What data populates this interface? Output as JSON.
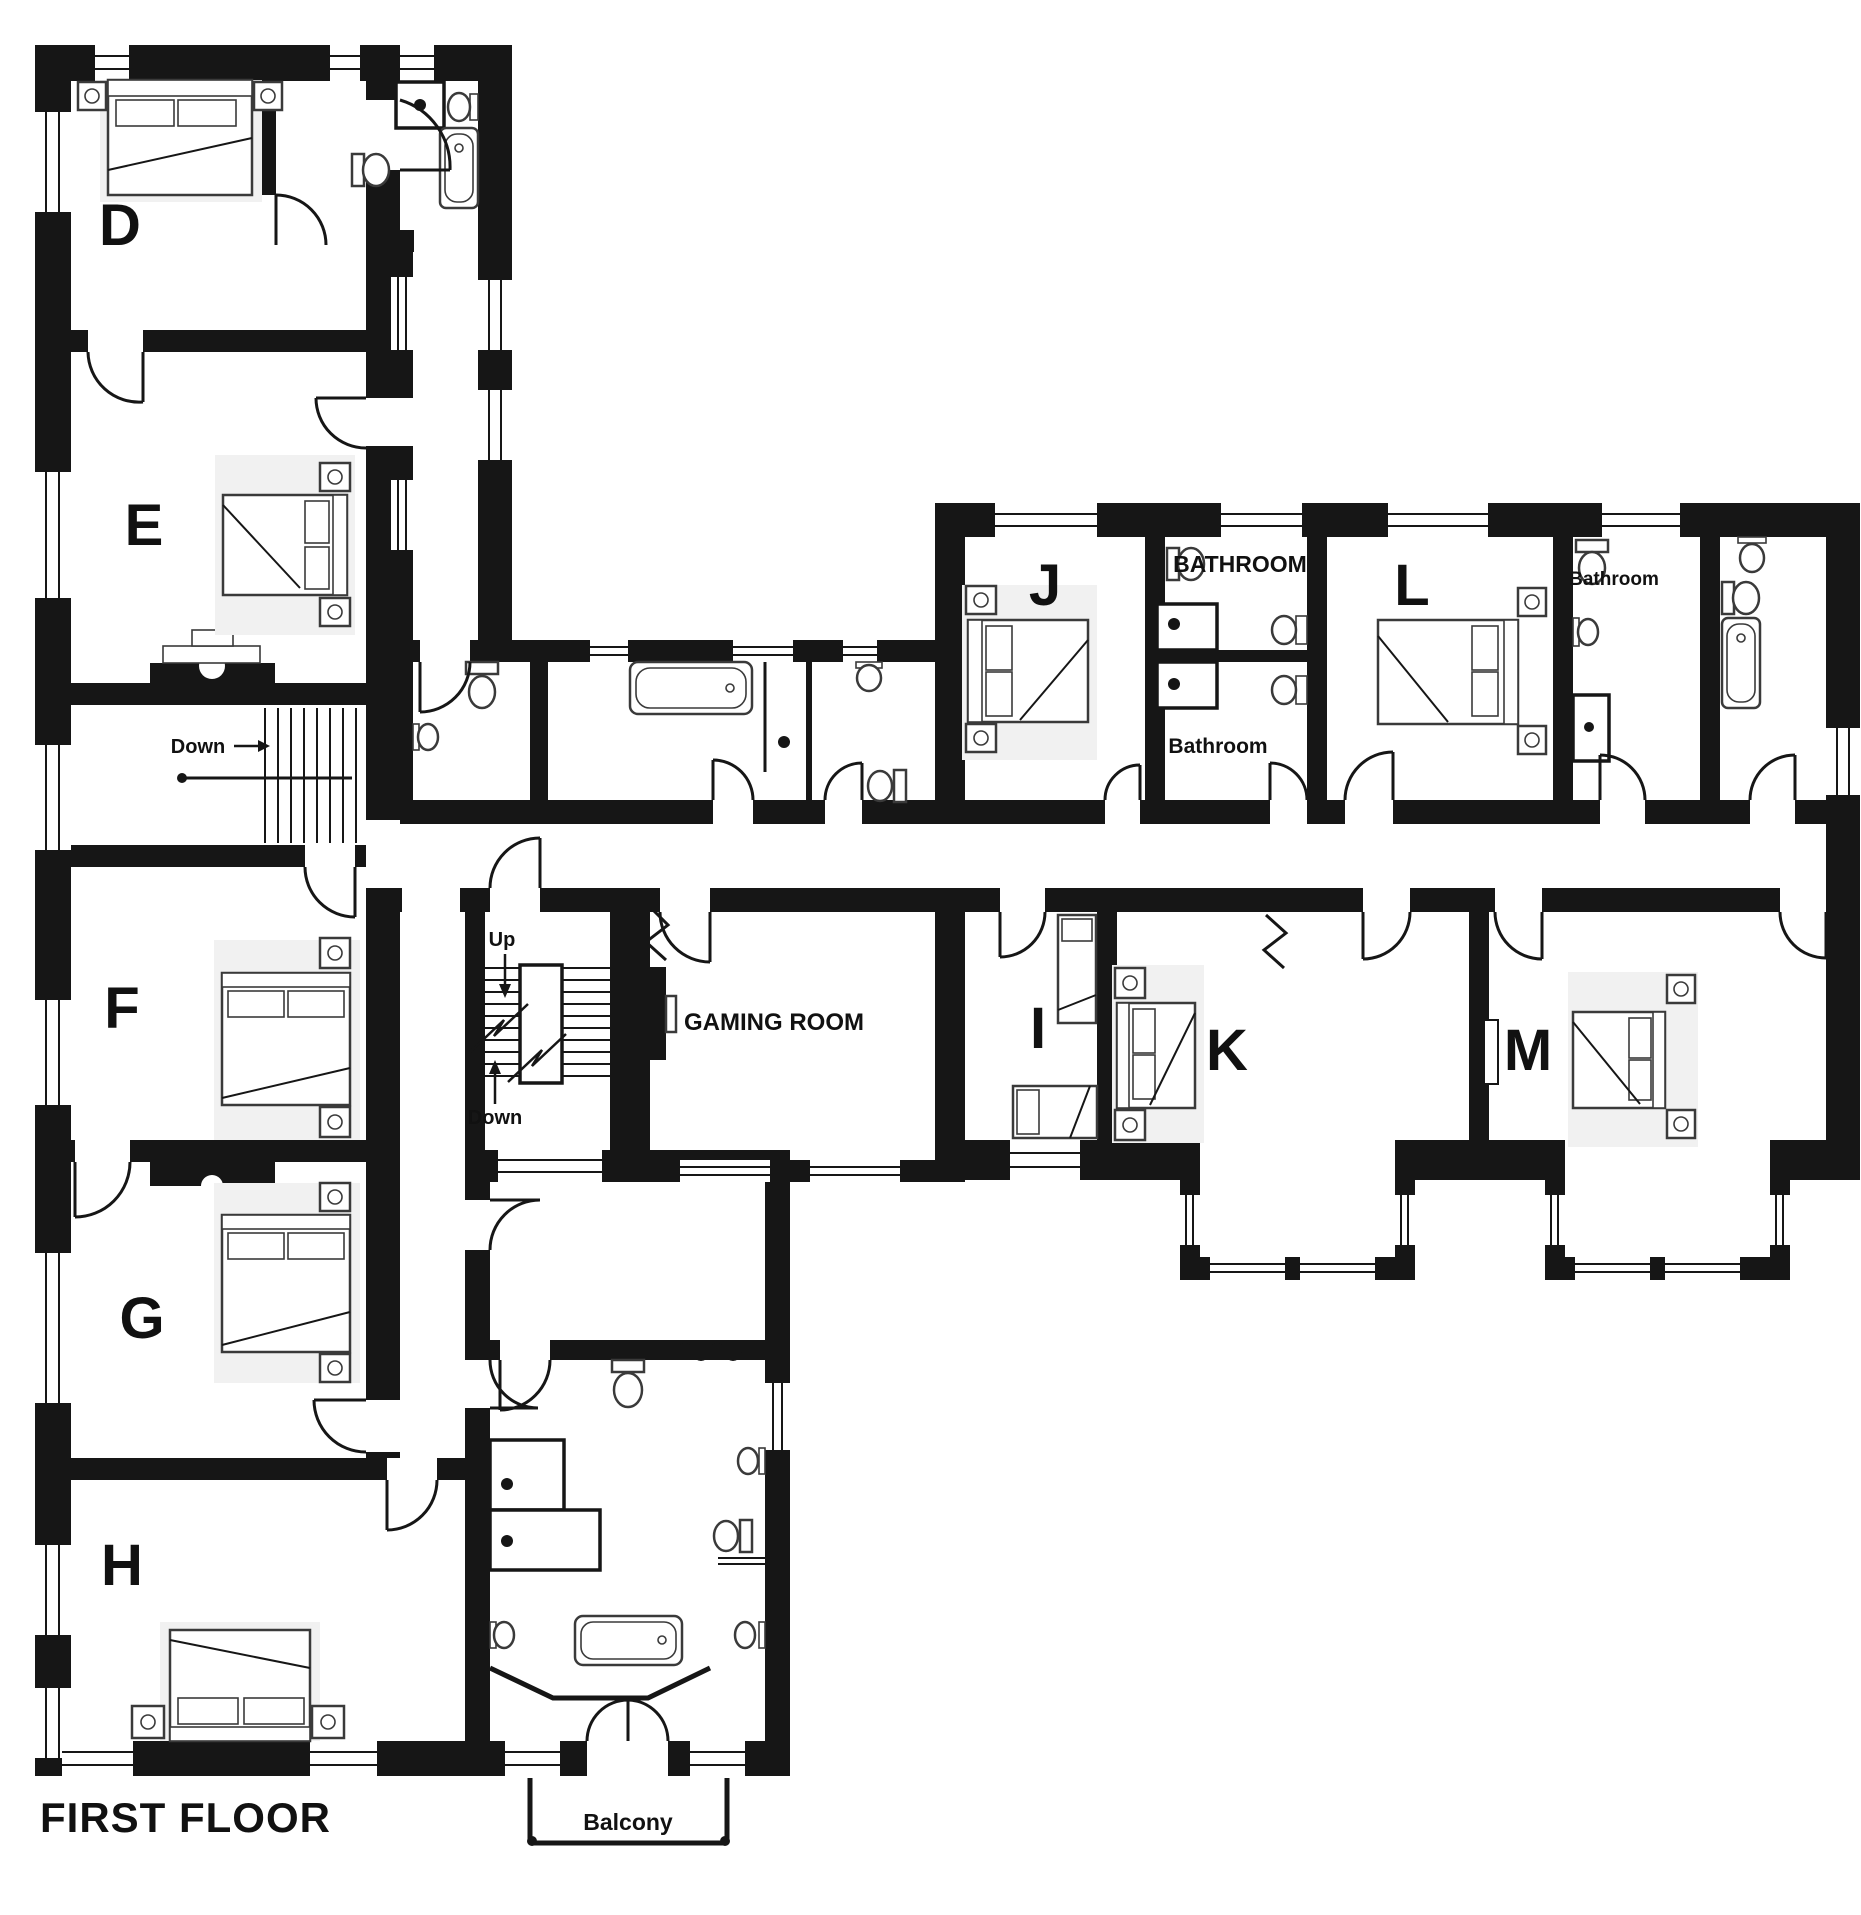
{
  "title": "FIRST FLOOR",
  "rooms": {
    "d": "D",
    "e": "E",
    "f": "F",
    "g": "G",
    "h": "H",
    "i": "I",
    "j": "J",
    "k": "K",
    "l": "L",
    "m": "M"
  },
  "areas": {
    "gaming_room": "GAMING ROOM",
    "bathroom_main": "BATHROOM",
    "bathroom_mid": "Bathroom",
    "bathroom_small": "Bathroom",
    "balcony": "Balcony"
  },
  "stairs": {
    "left_down": "Down",
    "center_up": "Up",
    "center_down": "Down"
  },
  "colors": {
    "wall": "#161616",
    "text": "#111111",
    "furniture_line": "#3a3a3a",
    "background": "#ffffff"
  }
}
